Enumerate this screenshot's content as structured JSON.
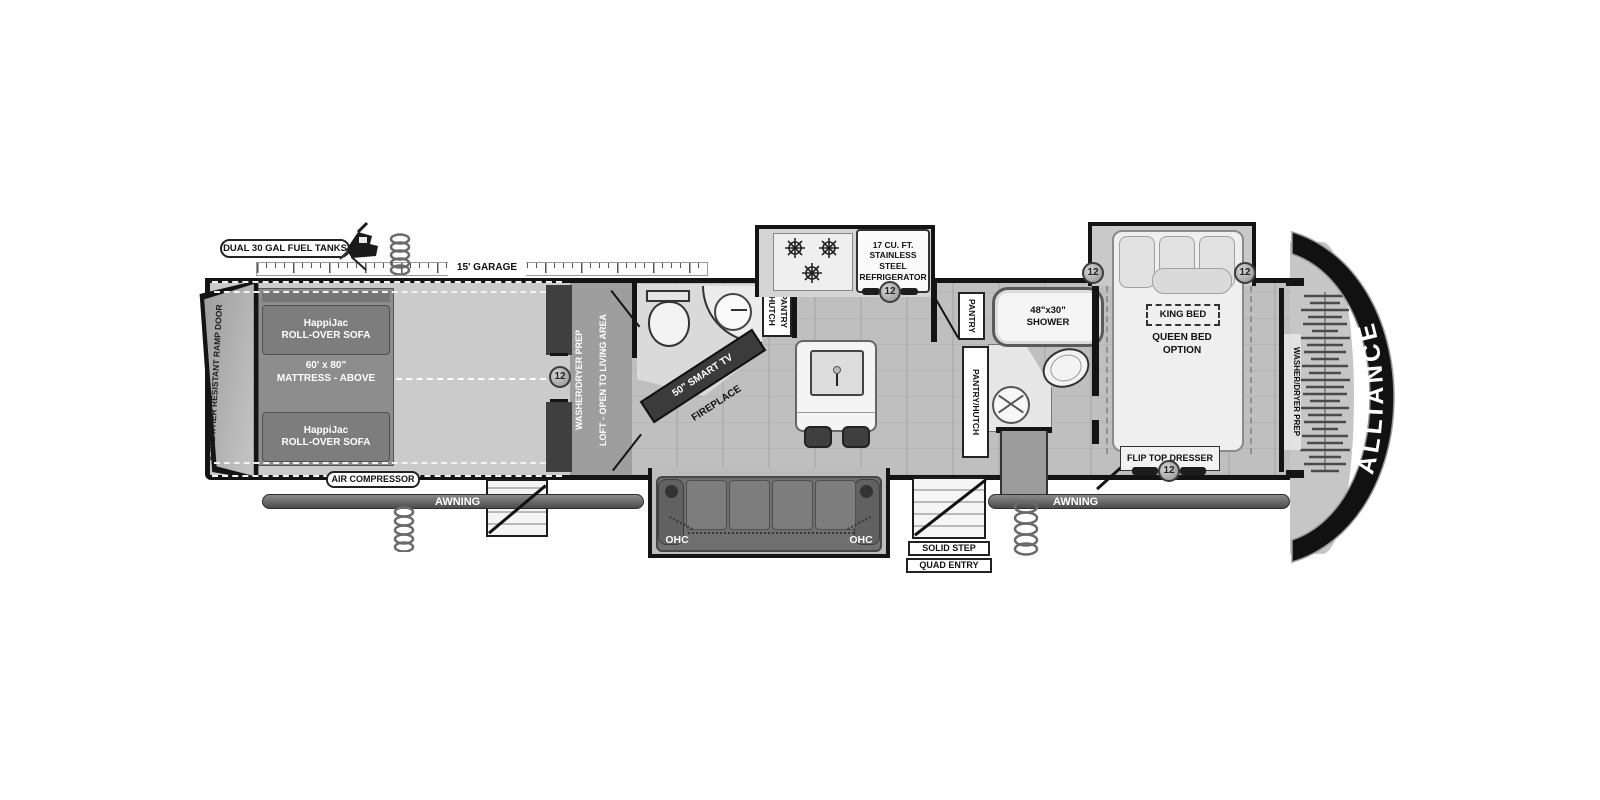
{
  "colors": {
    "wall": "#141414",
    "floor_garage": "#cbcbcb",
    "floor_main": "#bfbfbf",
    "loft": "#9e9e9e",
    "furniture_dark": "#6f6f6f",
    "fixture_light": "#f2f2f2",
    "front_cap": "#111111"
  },
  "exterior": {
    "brand": "ALLIANCE",
    "fuel_tanks_label": "DUAL 30 GAL FUEL TANKS",
    "garage_length_label": "15' GARAGE",
    "ramp_door_label": "8' WEATHER RESISTANT RAMP DOOR",
    "air_compressor_label": "AIR COMPRESSOR",
    "awning_left_label": "AWNING",
    "awning_right_label": "AWNING",
    "entry_step_label_1": "SOLID STEP",
    "entry_step_label_2": "QUAD ENTRY"
  },
  "garage": {
    "sofa_front_label": "HappiJac\nROLL-OVER SOFA",
    "sofa_rear_label": "HappiJac\nROLL-OVER SOFA",
    "mattress_label": "60' x 80\"\nMATTRESS - ABOVE",
    "door_marker": "12"
  },
  "loft": {
    "washer_dryer_label": "WASHER/DRYER PREP",
    "open_label": "LOFT - OPEN TO LIVING AREA"
  },
  "living": {
    "tv_label": "50\" SMART TV",
    "fireplace_label": "FIREPLACE",
    "ohc_left_label": "OHC",
    "ohc_right_label": "OHC",
    "hutch_pantry_label": "HUTCH\nPANTRY"
  },
  "kitchen": {
    "fridge_label": "17 CU. FT.\nSTAINLESS STEEL\nREFRIGERATOR",
    "fridge_marker": "12",
    "pantry_label": "PANTRY",
    "pantry_hutch_label": "PANTRY/HUTCH"
  },
  "bathroom": {
    "shower_label": "48\"x30\"\nSHOWER"
  },
  "bedroom": {
    "king_label": "KING BED",
    "queen_label": "QUEEN BED\nOPTION",
    "slide_marker_left": "12",
    "slide_marker_right": "12",
    "dresser_label": "FLIP TOP DRESSER",
    "dresser_marker": "12",
    "closet_label": "WASHER/DRYER PREP"
  }
}
